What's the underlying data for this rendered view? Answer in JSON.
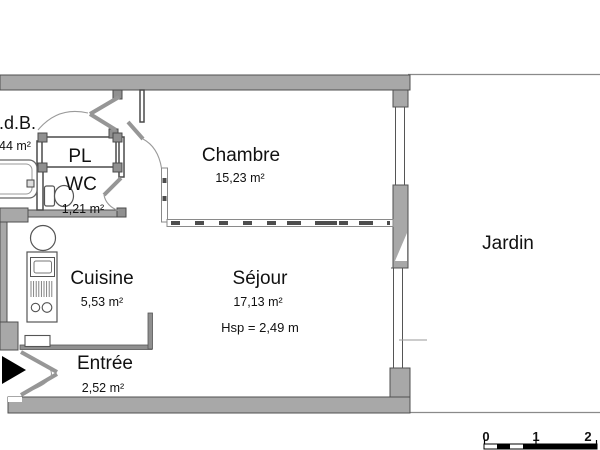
{
  "plan": {
    "rooms": {
      "sdb": {
        "name": "S.d.B.",
        "area": "44 m²"
      },
      "pl": {
        "name": "PL"
      },
      "wc": {
        "name": "WC",
        "area": "1,21 m²"
      },
      "chambre": {
        "name": "Chambre",
        "area": "15,23 m²"
      },
      "cuisine": {
        "name": "Cuisine",
        "area": "5,53 m²"
      },
      "sejour": {
        "name": "Séjour",
        "area": "17,13 m²",
        "ceiling_height": "Hsp = 2,49 m"
      },
      "entree": {
        "name": "Entrée",
        "area": "2,52 m²"
      },
      "jardin": {
        "name": "Jardin"
      }
    },
    "scale_bar": {
      "labels": [
        "0",
        "1",
        "2"
      ]
    },
    "colors": {
      "wall": "#a8a8a8",
      "wall_outline": "#4f4f4f",
      "partition": "#8f8f8f",
      "fixture_outline": "#555555",
      "text": "#111111",
      "entrance_arrow": "#000000"
    }
  }
}
